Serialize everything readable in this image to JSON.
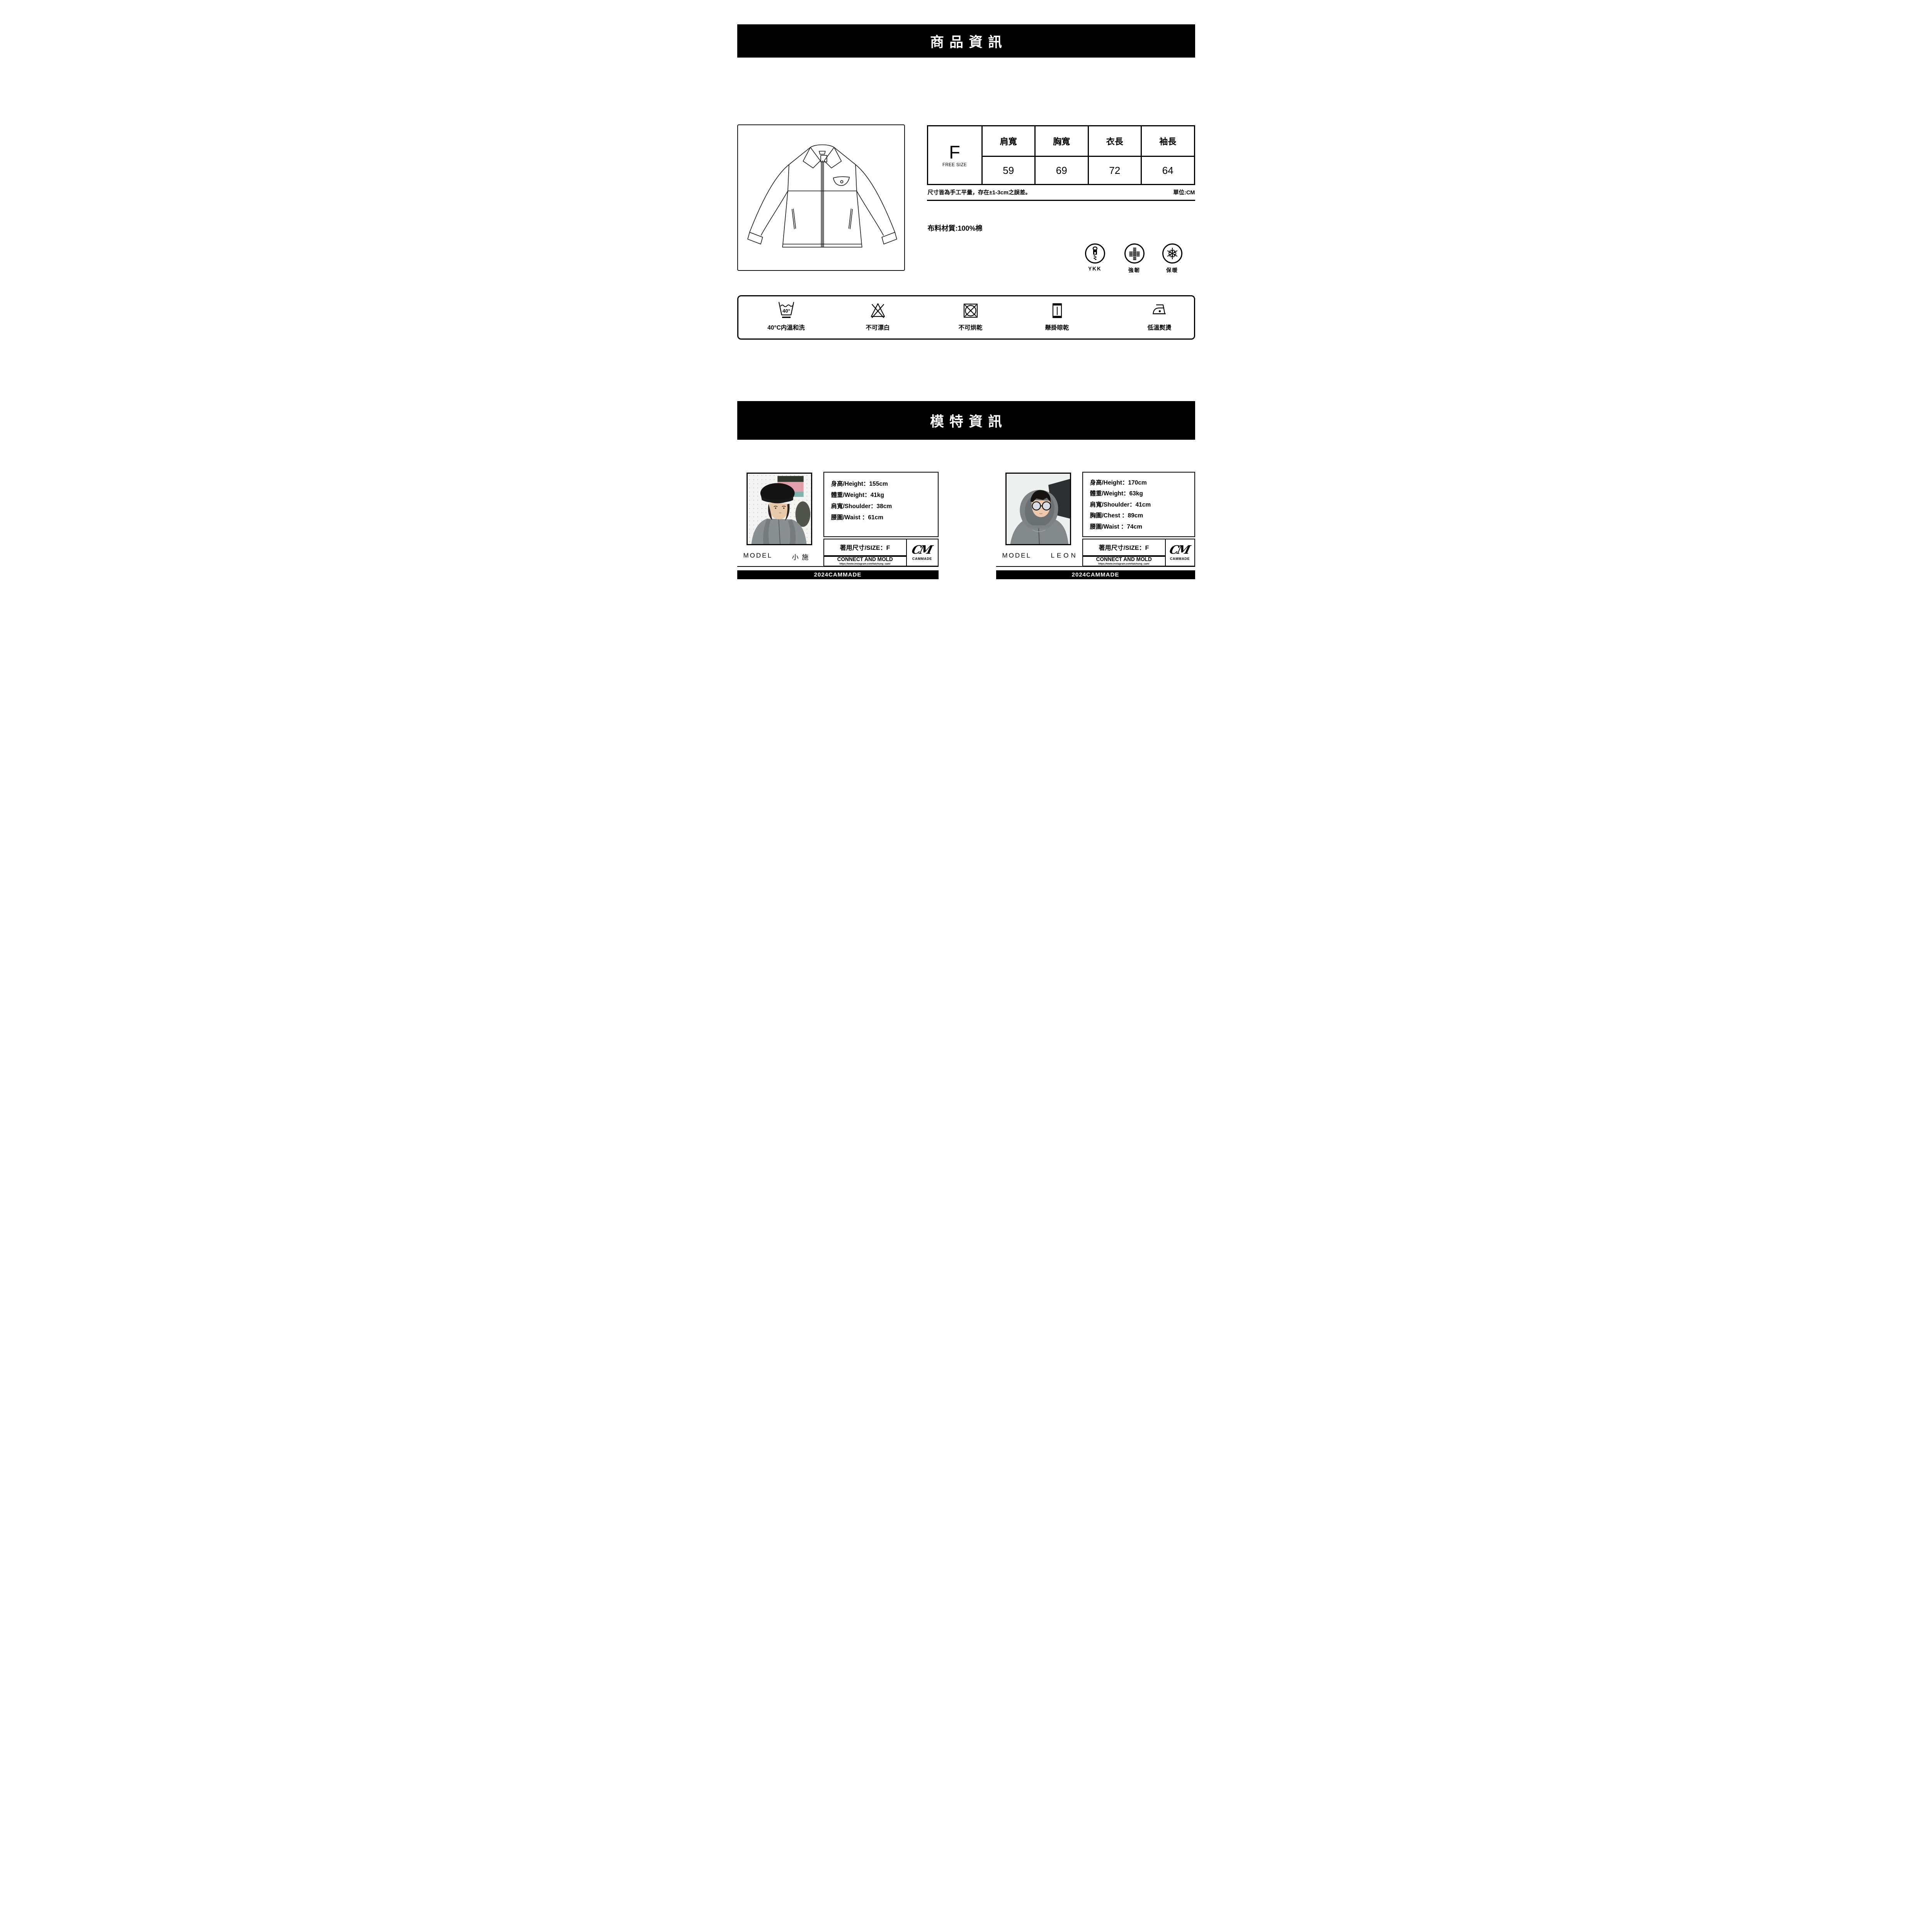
{
  "banners": {
    "product": "商品資訊",
    "model": "模特資訊"
  },
  "size_chart": {
    "size": "F",
    "size_caption": "FREE SIZE",
    "columns": [
      "肩寬",
      "胸寬",
      "衣長",
      "袖長"
    ],
    "values": [
      "59",
      "69",
      "72",
      "64"
    ],
    "note": "尺寸皆為手工平量，存在±1-3cm之誤差。",
    "unit": "單位:CM"
  },
  "fabric": "布料材質:100%棉",
  "badges": [
    {
      "icon": "zipper-icon",
      "label": "YKK"
    },
    {
      "icon": "weave-icon",
      "label": "強韌"
    },
    {
      "icon": "snowflake-icon",
      "label": "保暖"
    }
  ],
  "care": [
    {
      "icon": "wash-40-icon",
      "label": "40°C内溫和洗"
    },
    {
      "icon": "no-bleach-icon",
      "label": "不可漂白"
    },
    {
      "icon": "no-tumble-dry-icon",
      "label": "不可烘乾"
    },
    {
      "icon": "hang-dry-icon",
      "label": "懸掛晾乾"
    },
    {
      "icon": "iron-low-icon",
      "label": "低溫熨燙"
    }
  ],
  "models": [
    {
      "label": "MODEL",
      "name": "小 施",
      "stats": [
        "身高/Height：155cm",
        "體重/Weight：41kg",
        "肩寬/Shoulder：38cm",
        "腰圍/Waist ：61cm"
      ],
      "size_line": "著用尺寸/SIZE：F",
      "brand": "CONNECT AND MOLD",
      "brand_url": "https://www.instagram.com/taichung_cam/",
      "logo": "CM",
      "logo_caption": "CAMMADE",
      "footer": "2024CAMMADE"
    },
    {
      "label": "MODEL",
      "name": "LEON",
      "stats": [
        "身高/Height：170cm",
        "體重/Weight：63kg",
        "肩寬/Shoulder：41cm",
        "胸圍/Chest ：89cm",
        "腰圍/Waist ：74cm"
      ],
      "size_line": "著用尺寸/SIZE：F",
      "brand": "CONNECT AND MOLD",
      "brand_url": "https://www.instagram.com/taichung_cam/",
      "logo": "CM",
      "logo_caption": "CAMMADE",
      "footer": "2024CAMMADE"
    }
  ]
}
